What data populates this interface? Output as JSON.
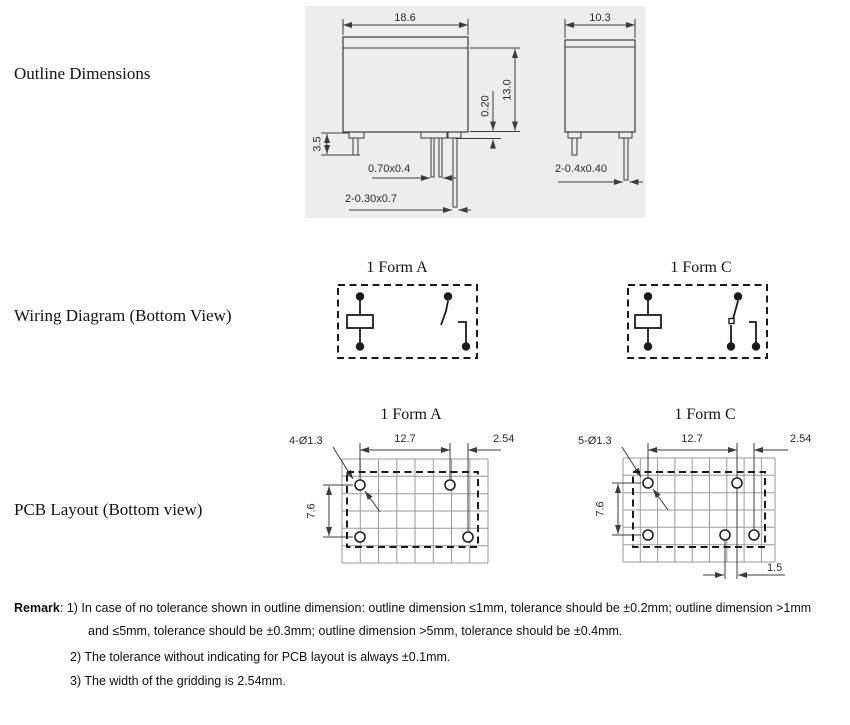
{
  "sections": {
    "outline_label": "Outline Dimensions",
    "wiring_label": "Wiring Diagram (Bottom View)",
    "pcb_label": "PCB Layout (Bottom view)"
  },
  "outline_view": {
    "front": {
      "width": "18.6",
      "pin_length": "3.5",
      "standoff": "0.20",
      "height": "13.0",
      "coil_pin_size": "0.70x0.4",
      "contact_pin_size": "2-0.30x0.7"
    },
    "side": {
      "width": "10.3",
      "pin_size": "2-0.4x0.40"
    }
  },
  "wiring": {
    "form_a": {
      "title": "1 Form A"
    },
    "form_c": {
      "title": "1 Form C"
    }
  },
  "pcb": {
    "form_a": {
      "title": "1 Form A",
      "holes": "4-Ø1.3",
      "pitch": "12.7",
      "offset": "2.54",
      "row_gap": "7.6"
    },
    "form_c": {
      "title": "1 Form C",
      "holes": "5-Ø1.3",
      "pitch": "12.7",
      "offset": "2.54",
      "row_gap": "7.6",
      "nc_offset": "1.5"
    }
  },
  "remark": {
    "label": "Remark",
    "line1": ": 1) In case of no tolerance shown in outline dimension: outline dimension ≤1mm, tolerance should be ±0.2mm; outline dimension >1mm",
    "line2": "and ≤5mm, tolerance should be ±0.3mm; outline dimension >5mm, tolerance should be ±0.4mm.",
    "line3": "2) The tolerance without indicating for PCB layout is always ±0.1mm.",
    "line4": "3) The width of the gridding is 2.54mm."
  }
}
